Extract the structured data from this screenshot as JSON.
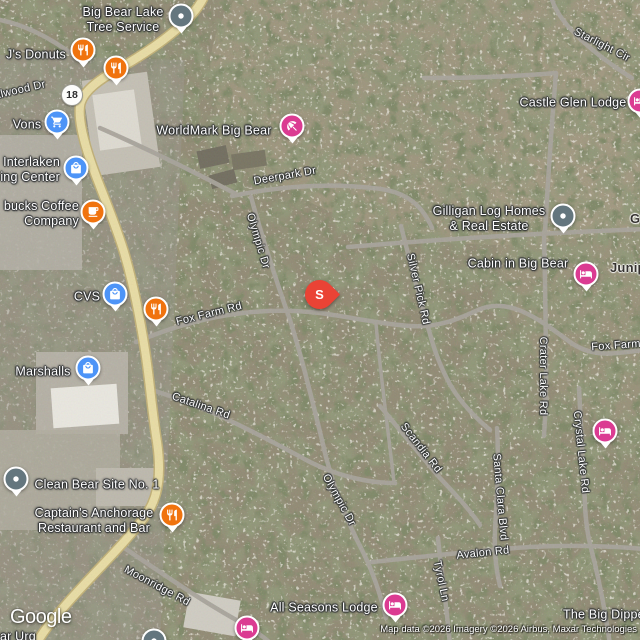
{
  "branding": {
    "logo": "Google"
  },
  "attribution": {
    "text": "Map data ©2026 Imagery ©2026 Airbus, Maxar Technologies"
  },
  "selected_marker": {
    "letter": "S",
    "x": 319,
    "y": 315
  },
  "route_shield": {
    "label": "18",
    "x": 72,
    "y": 95
  },
  "colors": {
    "restaurant": "#F0730E",
    "shopping": "#4D94F7",
    "lodging": "#DB3B92",
    "generic": "#64767E",
    "selected": "#EA4335"
  },
  "pois": [
    {
      "id": "big-bear-lake-tree-service",
      "icon": "dot-icon",
      "color": "generic",
      "pin": {
        "x": 181,
        "y": 18
      },
      "label": {
        "lines": [
          "Big Bear Lake",
          "Tree Service"
        ],
        "x": 123,
        "y": 20,
        "anchor": "center"
      }
    },
    {
      "id": "js-donuts",
      "icon": "restaurant-icon",
      "color": "restaurant",
      "pin": {
        "x": 83,
        "y": 52
      },
      "label": {
        "lines": [
          "J's Donuts"
        ],
        "x": 36,
        "y": 55,
        "anchor": "center"
      }
    },
    {
      "id": "restaurant-unlabeled-1",
      "icon": "restaurant-icon",
      "color": "restaurant",
      "pin": {
        "x": 116,
        "y": 70
      }
    },
    {
      "id": "vons",
      "icon": "shopping-cart-icon",
      "color": "shopping",
      "pin": {
        "x": 57,
        "y": 124
      },
      "label": {
        "lines": [
          "Vons"
        ],
        "x": 27,
        "y": 125,
        "anchor": "center"
      }
    },
    {
      "id": "worldmark-big-bear",
      "icon": "beach-umbrella-icon",
      "color": "lodging",
      "pin": {
        "x": 292,
        "y": 128
      },
      "label": {
        "lines": [
          "WorldMark Big Bear"
        ],
        "x": 214,
        "y": 131,
        "anchor": "center"
      }
    },
    {
      "id": "interlaken-shopping-center",
      "icon": "shopping-bag-icon",
      "color": "shopping",
      "pin": {
        "x": 76,
        "y": 170
      },
      "label": {
        "lines": [
          "Interlaken",
          "ing Center"
        ],
        "x": 60,
        "y": 170,
        "anchor": "right"
      }
    },
    {
      "id": "starbucks-coffee-company",
      "icon": "coffee-cup-icon",
      "color": "restaurant",
      "pin": {
        "x": 93,
        "y": 214
      },
      "label": {
        "lines": [
          "bucks Coffee",
          "Company"
        ],
        "x": 79,
        "y": 214,
        "anchor": "right"
      }
    },
    {
      "id": "cvs",
      "icon": "shopping-bag-icon",
      "color": "shopping",
      "pin": {
        "x": 115,
        "y": 296
      },
      "label": {
        "lines": [
          "CVS"
        ],
        "x": 87,
        "y": 297,
        "anchor": "center"
      }
    },
    {
      "id": "restaurant-unlabeled-2",
      "icon": "restaurant-icon",
      "color": "restaurant",
      "pin": {
        "x": 156,
        "y": 311
      }
    },
    {
      "id": "marshalls",
      "icon": "shopping-bag-icon",
      "color": "shopping",
      "pin": {
        "x": 88,
        "y": 370
      },
      "label": {
        "lines": [
          "Marshalls"
        ],
        "x": 43,
        "y": 372,
        "anchor": "center"
      }
    },
    {
      "id": "clean-bear-site-no-1",
      "icon": "dot-icon",
      "color": "generic",
      "pin": {
        "x": 16,
        "y": 481
      },
      "label": {
        "lines": [
          "Clean Bear Site No. 1"
        ],
        "x": 97,
        "y": 485,
        "anchor": "center"
      }
    },
    {
      "id": "captains-anchorage",
      "icon": "restaurant-icon",
      "color": "restaurant",
      "pin": {
        "x": 172,
        "y": 517
      },
      "label": {
        "lines": [
          "Captain's Anchorage",
          "Restaurant and Bar"
        ],
        "x": 94,
        "y": 521,
        "anchor": "center"
      }
    },
    {
      "id": "gilligan-log-homes",
      "icon": "dot-icon",
      "color": "generic",
      "pin": {
        "x": 563,
        "y": 218
      },
      "label": {
        "lines": [
          "Gilligan Log Homes",
          "& Real Estate"
        ],
        "x": 489,
        "y": 219,
        "anchor": "center"
      }
    },
    {
      "id": "cabin-in-big-bear",
      "icon": "bed-icon",
      "color": "lodging",
      "pin": {
        "x": 586,
        "y": 276
      },
      "label": {
        "lines": [
          "Cabin in Big Bear"
        ],
        "x": 518,
        "y": 264,
        "anchor": "center"
      }
    },
    {
      "id": "castle-glen-lodge",
      "icon": "bed-icon",
      "color": "lodging",
      "pin": {
        "x": 640,
        "y": 103
      },
      "label": {
        "lines": [
          "Castle Glen Lodge"
        ],
        "x": 573,
        "y": 103,
        "anchor": "center"
      }
    },
    {
      "id": "juniper-area",
      "icon": null,
      "color": null,
      "label": {
        "lines": [
          "Juniper"
        ],
        "x": 610,
        "y": 268,
        "anchor": "left",
        "dark": true
      }
    },
    {
      "id": "g-partial-area",
      "icon": null,
      "color": null,
      "label": {
        "lines": [
          "G"
        ],
        "x": 630,
        "y": 219,
        "anchor": "left",
        "dark": true
      }
    },
    {
      "id": "all-seasons-lodge",
      "icon": "bed-icon",
      "color": "lodging",
      "pin": {
        "x": 395,
        "y": 607
      },
      "label": {
        "lines": [
          "All Seasons Lodge"
        ],
        "x": 324,
        "y": 608,
        "anchor": "center"
      }
    },
    {
      "id": "lodging-unlabeled-1",
      "icon": "bed-icon",
      "color": "lodging",
      "pin": {
        "x": 605,
        "y": 433
      }
    },
    {
      "id": "lodging-unlabeled-2",
      "icon": "bed-icon",
      "color": "lodging",
      "pin": {
        "x": 247,
        "y": 630
      }
    },
    {
      "id": "the-big-dipper",
      "icon": null,
      "color": null,
      "label": {
        "lines": [
          "The Big Dipper"
        ],
        "x": 563,
        "y": 615,
        "anchor": "left"
      }
    },
    {
      "id": "poi-cut-bottom-left",
      "icon": "dot-icon",
      "color": "generic",
      "pin": {
        "x": 154,
        "y": 643
      },
      "label": {
        "lines": [
          "ar Urg"
        ],
        "x": 0,
        "y": 637,
        "anchor": "left"
      }
    }
  ],
  "road_labels": [
    {
      "text": "alwood Dr",
      "x": 20,
      "y": 90,
      "rot": -13
    },
    {
      "text": "Deerpark Dr",
      "x": 285,
      "y": 176,
      "rot": -10
    },
    {
      "text": "Olympic Dr",
      "x": 258,
      "y": 241,
      "rot": 73
    },
    {
      "text": "Fox Farm Rd",
      "x": 209,
      "y": 314,
      "rot": -14
    },
    {
      "text": "Silver Pick Rd",
      "x": 418,
      "y": 289,
      "rot": 77
    },
    {
      "text": "Catalina Rd",
      "x": 201,
      "y": 406,
      "rot": 19
    },
    {
      "text": "Scandia Rd",
      "x": 421,
      "y": 448,
      "rot": 52
    },
    {
      "text": "Olympic Dr",
      "x": 339,
      "y": 500,
      "rot": 61
    },
    {
      "text": "Santa Clara Blvd",
      "x": 500,
      "y": 497,
      "rot": 85
    },
    {
      "text": "Avalon Rd",
      "x": 483,
      "y": 553,
      "rot": -6
    },
    {
      "text": "Tyrol Ln",
      "x": 441,
      "y": 581,
      "rot": 78
    },
    {
      "text": "Moonridge Rd",
      "x": 157,
      "y": 586,
      "rot": 28
    },
    {
      "text": "Crater Lake Rd",
      "x": 543,
      "y": 376,
      "rot": 90
    },
    {
      "text": "Crystal Lake Rd",
      "x": 581,
      "y": 452,
      "rot": 84
    },
    {
      "text": "Starlight Cir",
      "x": 602,
      "y": 45,
      "rot": 27
    },
    {
      "text": "Fox Farm Rd",
      "x": 625,
      "y": 345,
      "rot": -4
    }
  ]
}
